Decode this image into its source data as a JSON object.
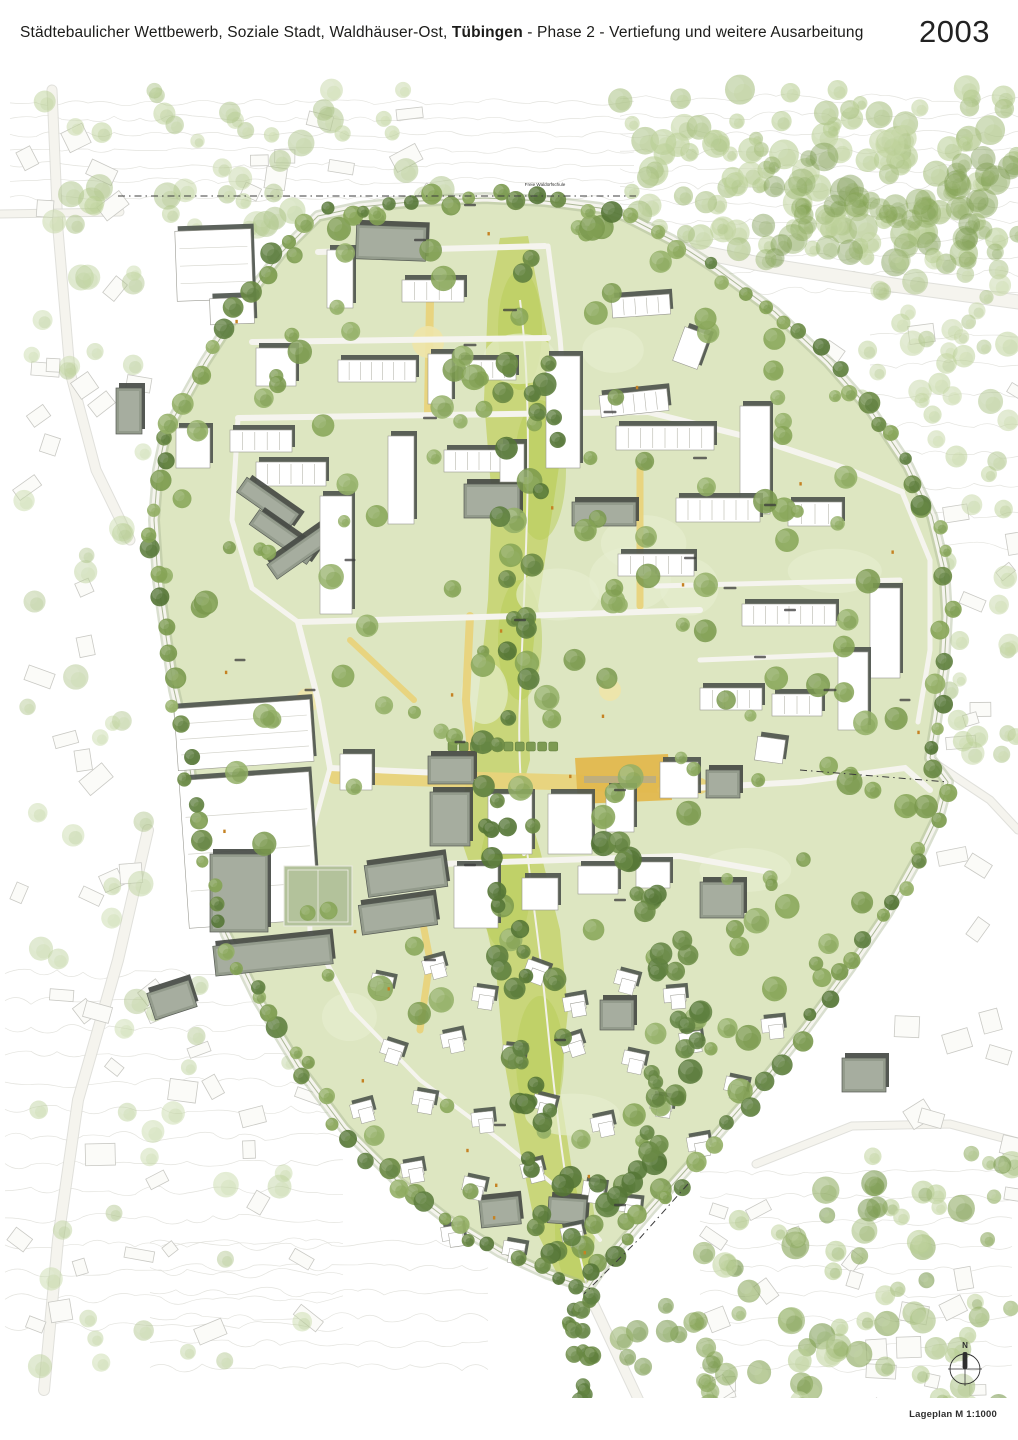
{
  "header": {
    "title_prefix": "Städtebaulicher Wettbewerb, Soziale Stadt, Waldhäuser-Ost, ",
    "title_emphasis": "Tübingen",
    "title_suffix": " - Phase 2 - Vertiefung und weitere Ausarbeitung",
    "year": "2003"
  },
  "map": {
    "caption": "Lageplan M 1:1000",
    "north_label": "N",
    "labels": {
      "school": "Freie Waldorfschule"
    },
    "colors": {
      "page_bg": "#ffffff",
      "site_green": "#dde6c1",
      "lawn_light": "#e7eecf",
      "valley_green": "#c6d472",
      "valley_bright": "#b8cc55",
      "tree_green": "#85a355",
      "tree_mid": "#93af66",
      "tree_dark": "#5f8040",
      "tree_pale": "#b9cf94",
      "street_yellow": "#e8d37b",
      "plaza_orange": "#e2b84e",
      "building_white": "#ffffff",
      "building_shadow": "#4e554e",
      "roof_gray": "#939b8c",
      "roof_inner": "#a9b0a2",
      "court_green": "#b3c29b",
      "context_line": "#c9c9c4",
      "contour_line": "#dcdcd6",
      "road_white": "#f5f4ee",
      "road_edge": "#aab795",
      "marker_orange": "#c58223",
      "ink": "#1d1d1b"
    }
  }
}
